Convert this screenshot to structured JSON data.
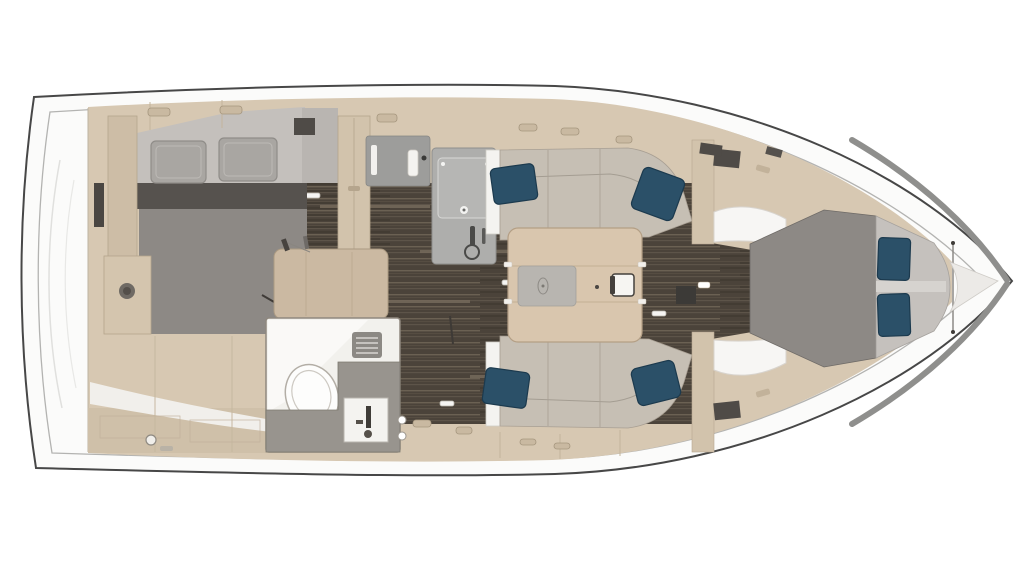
{
  "scene": {
    "type": "sailing-yacht-interior-floor-plan",
    "view": "top-down-render",
    "orientation": "stern-left-bow-right"
  },
  "colors": {
    "background": "#ffffff",
    "hull_fill": "#fbfbfa",
    "hull_stroke": "#474747",
    "deck_line": "#b3b3b1",
    "bow_band": "#8f8f8d",
    "furniture_tan": "#d7c8b2",
    "furniture_tan_dark": "#cdbda6",
    "wardrobe_tan": "#d2c3ac",
    "desk_tan": "#cbb9a2",
    "table_tan": "#d9c6ae",
    "floor_dark": "#4b433a",
    "wall_gray": "#c4c0bc",
    "headboard_gray": "#56524e",
    "bed_gray": "#8d8985",
    "bed_head_light": "#c5c1bd",
    "pillow_gray": "#a9a6a2",
    "pillow_navy": "#2b5068",
    "sofa_beige": "#c6bfb4",
    "counter_gray": "#aeaeac",
    "stove_gray": "#9d9d9b",
    "vanity_gray": "#98948e",
    "bathroom_white": "#f2f1ed",
    "white_trim": "#f4f3f0",
    "hatch_dark": "#4f4b47"
  },
  "rooms": [
    {
      "id": "aft-cabin",
      "features": [
        "double-berth",
        "gray-pillows",
        "wardrobe",
        "nightstand"
      ]
    },
    {
      "id": "head-bathroom",
      "features": [
        "toilet",
        "sink",
        "vanity-counter",
        "vent-grate"
      ]
    },
    {
      "id": "galley",
      "features": [
        "counter",
        "sink",
        "faucet",
        "stove-top"
      ]
    },
    {
      "id": "salon",
      "features": [
        "port-sofa",
        "starboard-sofa",
        "folding-table",
        "navy-pillows"
      ]
    },
    {
      "id": "forward-cabin",
      "features": [
        "v-berth",
        "navy-pillows",
        "side-lockers"
      ]
    }
  ],
  "counts": {
    "navy_pillows": 6,
    "gray_pillows": 2,
    "cabins": 2,
    "bathrooms": 1,
    "sofas": 2
  }
}
